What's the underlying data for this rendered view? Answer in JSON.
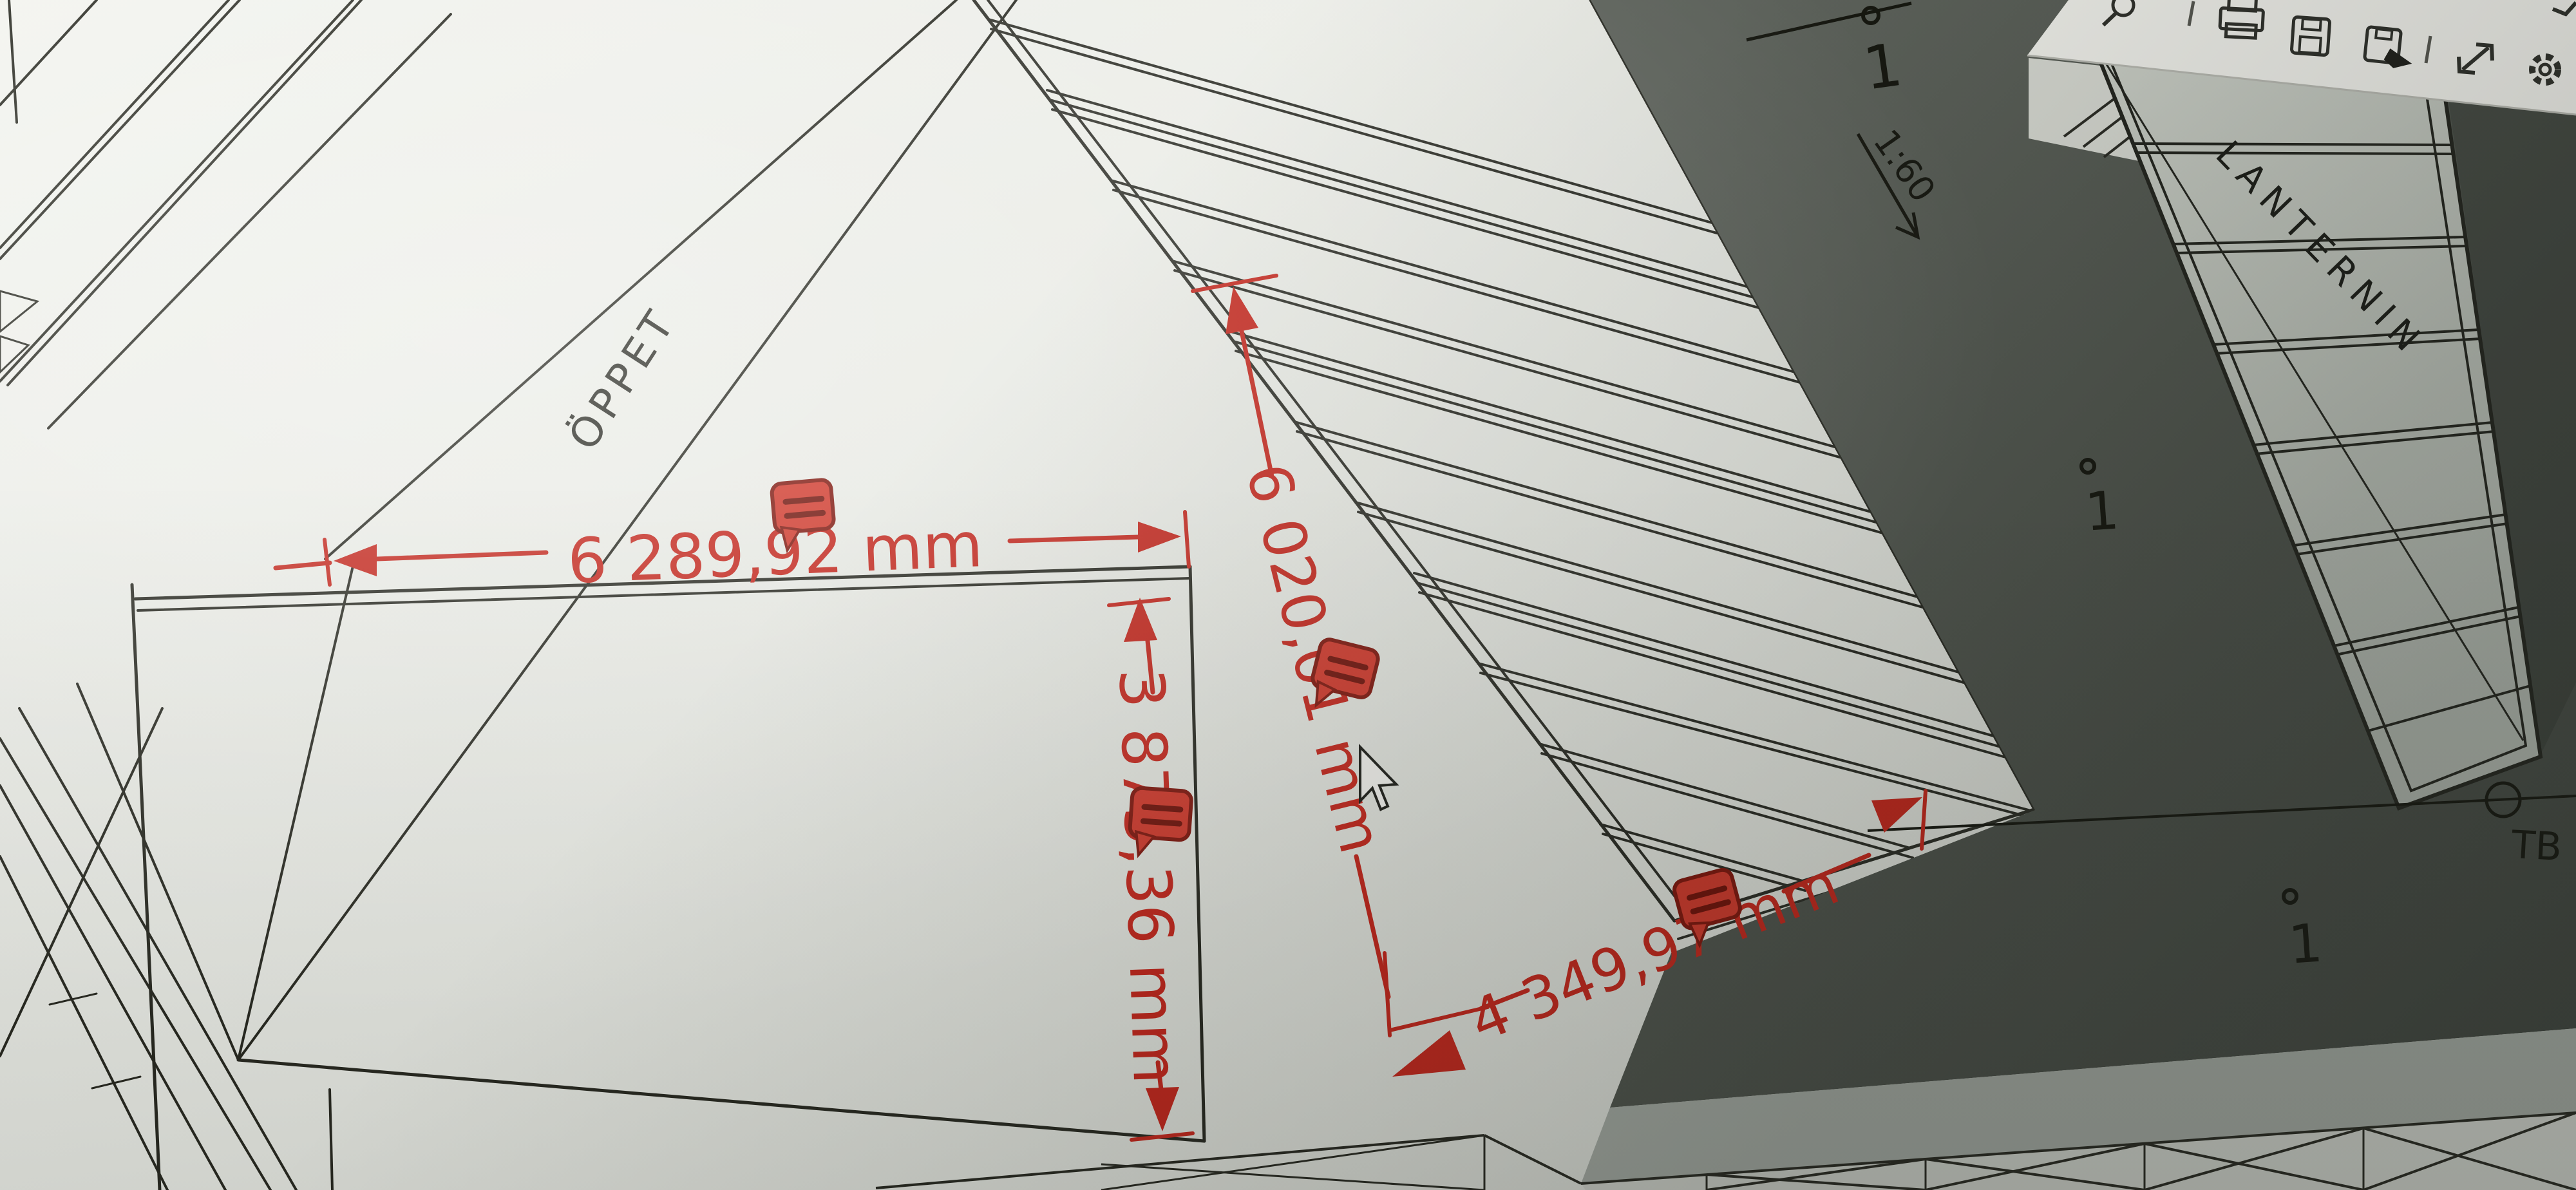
{
  "viewer_toolbar": {
    "icons": [
      {
        "name": "search-zoom-icon"
      },
      {
        "name": "print-icon"
      },
      {
        "name": "save-icon"
      },
      {
        "name": "save-as-icon"
      },
      {
        "name": "fullscreen-expand-icon"
      },
      {
        "name": "settings-gear-icon"
      }
    ]
  },
  "markup": {
    "dim_top": "6 289,92 mm",
    "dim_left_vertical": "3 875,36 mm",
    "dim_roof_slope": "6 020,01 mm",
    "dim_roof_bottom": "4 349,97 mm",
    "markup_color": "#c3251b"
  },
  "plan": {
    "open_area_label": "ÖPPET",
    "skylight_label": "LANTERNIN",
    "point_label_tb": "TB",
    "slope_ratio": "1:60",
    "detail_markers": [
      "1",
      "1",
      "1"
    ]
  },
  "colors": {
    "paper": "#e7e8e2",
    "ink": "#26271f",
    "roof_dark": "#4c514b",
    "markup_red": "#c3251b"
  }
}
